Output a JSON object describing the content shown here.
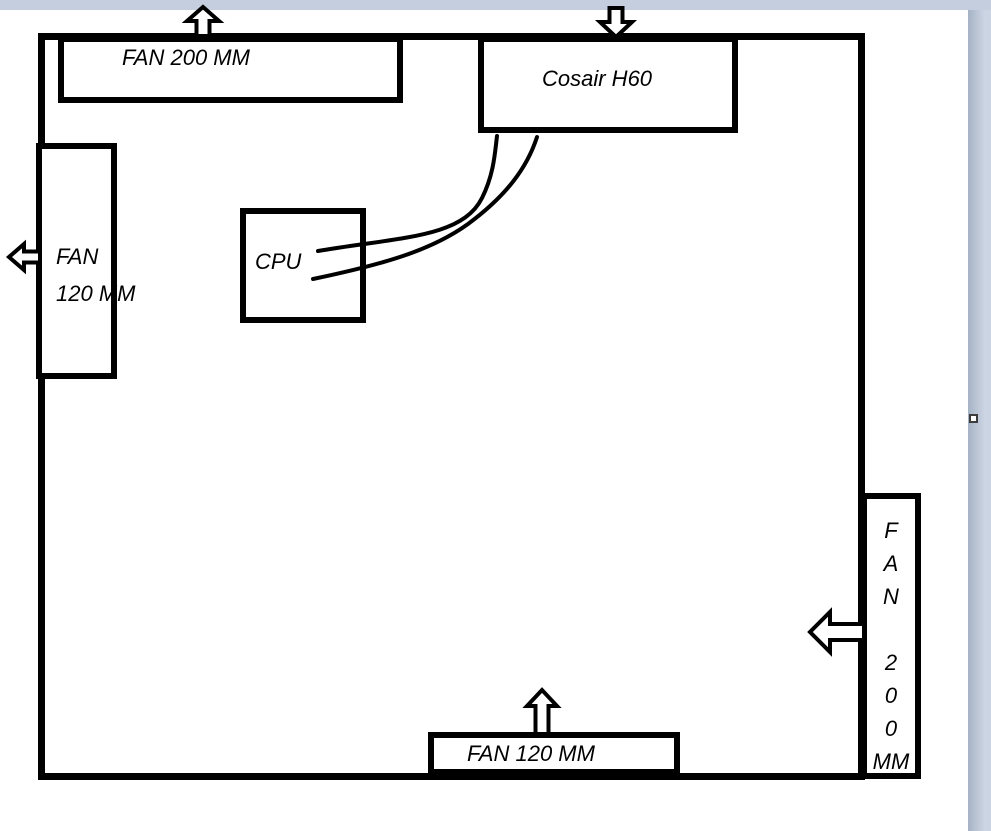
{
  "window": {
    "page_color": "#ffffff",
    "margin_color": "#c5cede",
    "shape_stroke_color": "#000000"
  },
  "diagram": {
    "fan_top": {
      "label": "FAN 200 MM",
      "airflow_icon": "arrow-up-icon"
    },
    "cooler": {
      "label": "Cosair H60",
      "airflow_icon": "arrow-down-icon"
    },
    "fan_left": {
      "lines": [
        "FAN",
        "120 MM"
      ],
      "airflow_icon": "arrow-left-icon"
    },
    "cpu": {
      "label": "CPU"
    },
    "fan_bottom": {
      "label": "FAN 120 MM",
      "airflow_icon": "arrow-up-icon"
    },
    "fan_right": {
      "letters": [
        "F",
        "A",
        "N",
        "",
        "2",
        "0",
        "0",
        "MM"
      ],
      "airflow_icon": "arrow-left-icon"
    }
  }
}
